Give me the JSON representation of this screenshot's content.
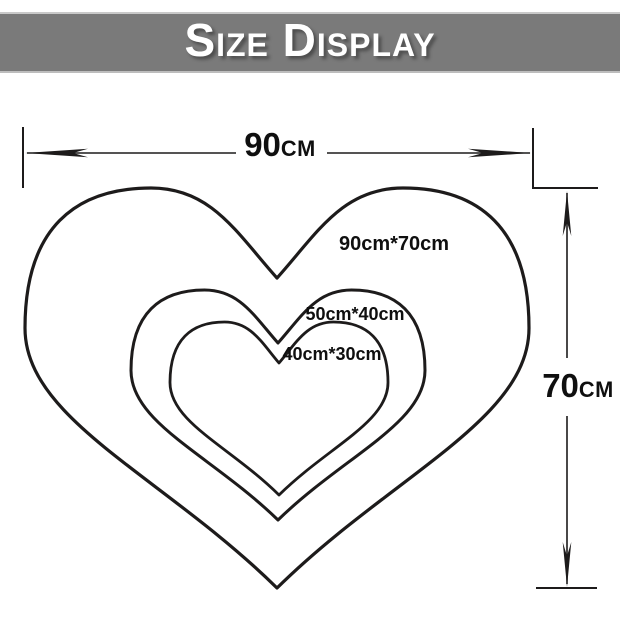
{
  "banner": {
    "title": "Size Display"
  },
  "diagram": {
    "width_dim": {
      "value": "90",
      "unit": "cm"
    },
    "height_dim": {
      "value": "70",
      "unit": "cm"
    },
    "hearts": [
      {
        "label": "90cm*70cm"
      },
      {
        "label": "50cm*40cm"
      },
      {
        "label": "40cm*30cm"
      }
    ]
  },
  "colors": {
    "banner_bg": "#7a7a7a",
    "banner_edge": "#c9c9c9",
    "line": "#1d1b1b",
    "text": "#0f0f0f"
  }
}
